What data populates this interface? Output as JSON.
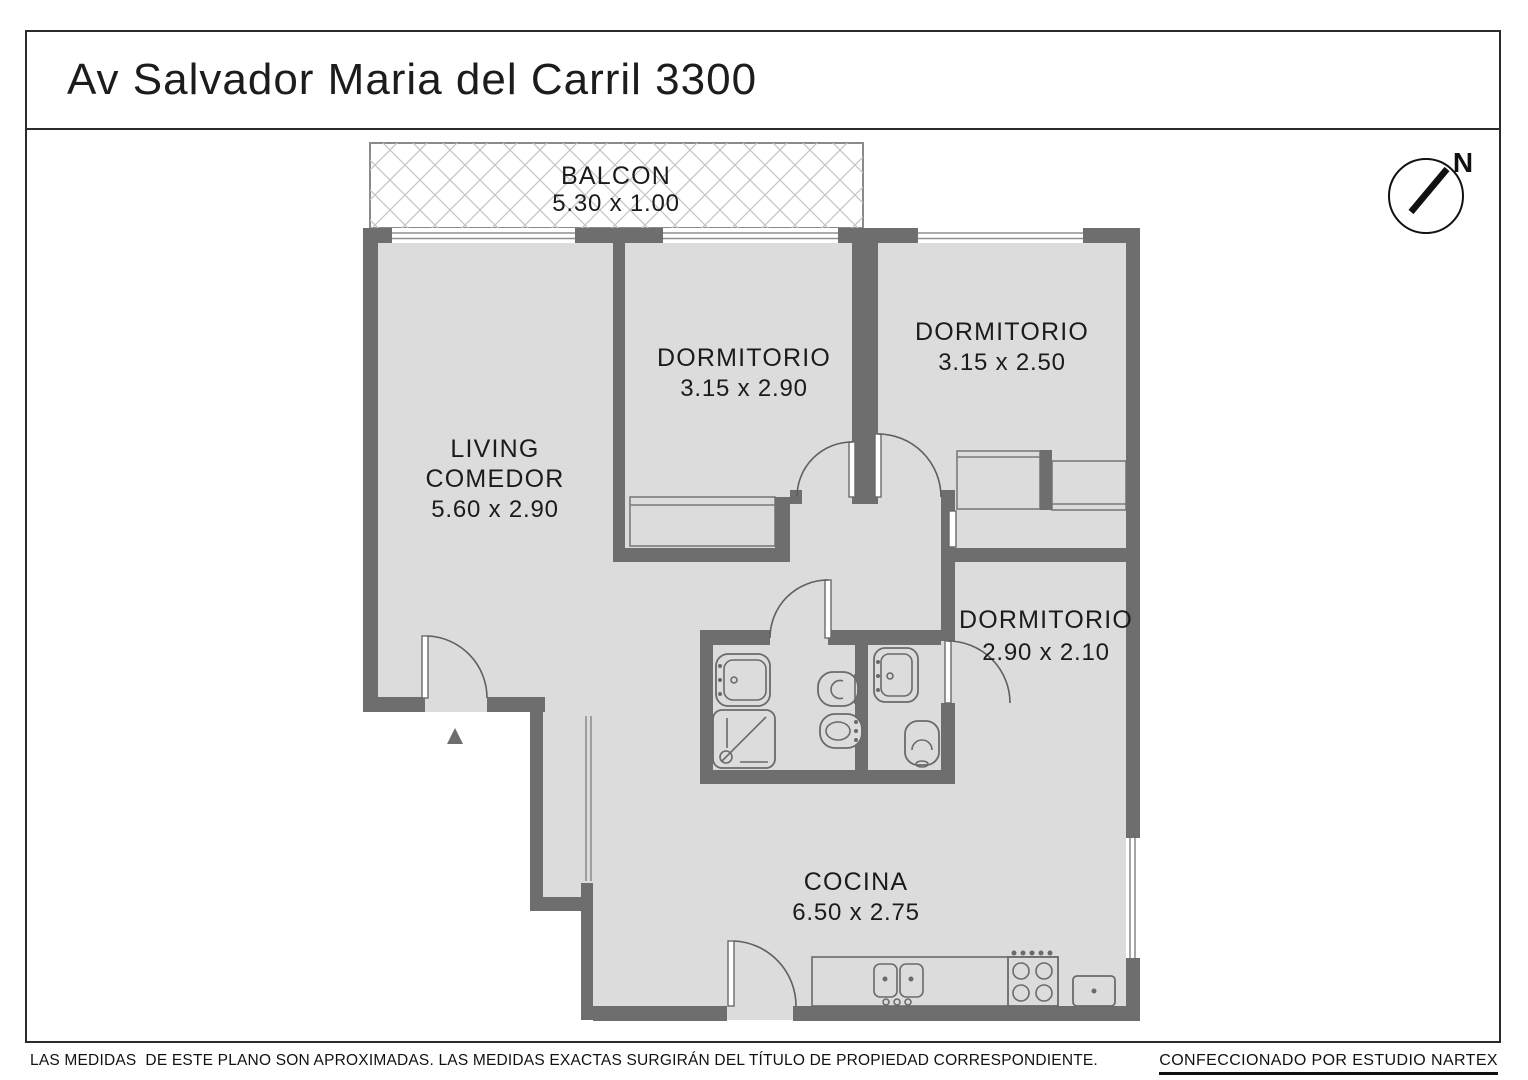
{
  "title": "Av Salvador Maria del Carril 3300",
  "compass": {
    "label": "N"
  },
  "balcony": {
    "label": "BALCON",
    "dims": "5.30 x 1.00"
  },
  "rooms": {
    "living": {
      "line1": "LIVING",
      "line2": "COMEDOR",
      "dims": "5.60 x 2.90"
    },
    "dorm1": {
      "name": "DORMITORIO",
      "dims": "3.15 x 2.90"
    },
    "dorm2": {
      "name": "DORMITORIO",
      "dims": "3.15 x 2.50"
    },
    "dorm3": {
      "name": "DORMITORIO",
      "dims": "2.90 x 2.10"
    },
    "cocina": {
      "name": "COCINA",
      "dims": "6.50 x 2.75"
    }
  },
  "footer": {
    "disclaimer": "LAS MEDIDAS  DE ESTE PLANO SON APROXIMADAS. LAS MEDIDAS EXACTAS SURGIRÁN DEL TÍTULO DE PROPIEDAD CORRESPONDIENTE.",
    "credit": "CONFECCIONADO POR ESTUDIO NARTEX"
  },
  "colors": {
    "wall": "#6e6e6e",
    "floor_fill": "#dcdcdc",
    "hatch_line": "#c4c4c4",
    "outline": "#2b2b2b",
    "text": "#1b1b1b"
  }
}
